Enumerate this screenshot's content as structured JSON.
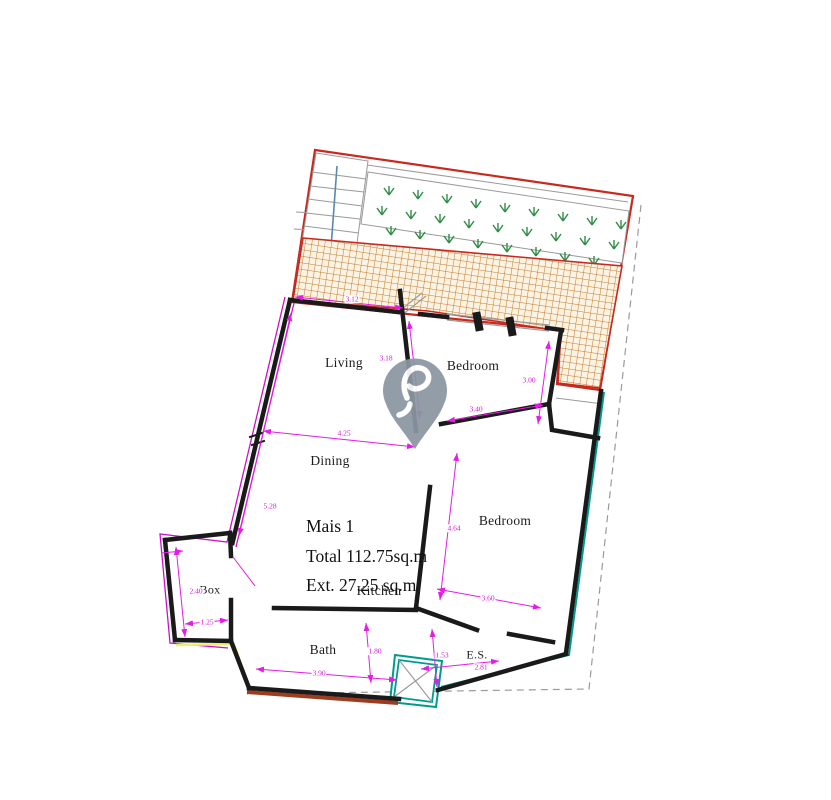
{
  "title_block": {
    "name": "Mais 1",
    "total": "Total 112.75sq.m",
    "ext": "Ext. 27.25 sq.m"
  },
  "rooms": {
    "living": "Living",
    "bedroom_top": "Bedroom",
    "dining": "Dining",
    "bedroom_right": "Bedroom",
    "kitchen": "Kitchen",
    "bath": "Bath",
    "es": "E.S.",
    "box": "Box"
  },
  "dimensions": {
    "living_width": "3.12",
    "living_depth": "3.18",
    "bedroom_top_width": "3.40",
    "bedroom_top_depth": "3.00",
    "dining_width": "4.25",
    "dining_depth": "5.28",
    "bedroom_right_depth": "4.64",
    "bedroom_right_width": "3.60",
    "box_depth": "2.40",
    "box_width": "1.25",
    "bath_width": "3.90",
    "bath_depth": "1.80",
    "es_depth": "1.53",
    "es_width": "2.81"
  },
  "colors": {
    "wall": "#1a1a1a",
    "dimension": "#e51ce5",
    "terrace_border": "#c8281e",
    "tile_hatch": "#c07a2e",
    "plant": "#2e8b44",
    "stair_arrow": "#5b87b0",
    "teal_boundary": "#009b8f",
    "dashed_boundary": "#9a9a9a",
    "brick_edge": "#9e3c20",
    "yellow_edge": "#ecef6e",
    "magenta_outline": "#cc10cc",
    "thin_gray": "#9a9a9a",
    "pin": "#8b96a2"
  }
}
